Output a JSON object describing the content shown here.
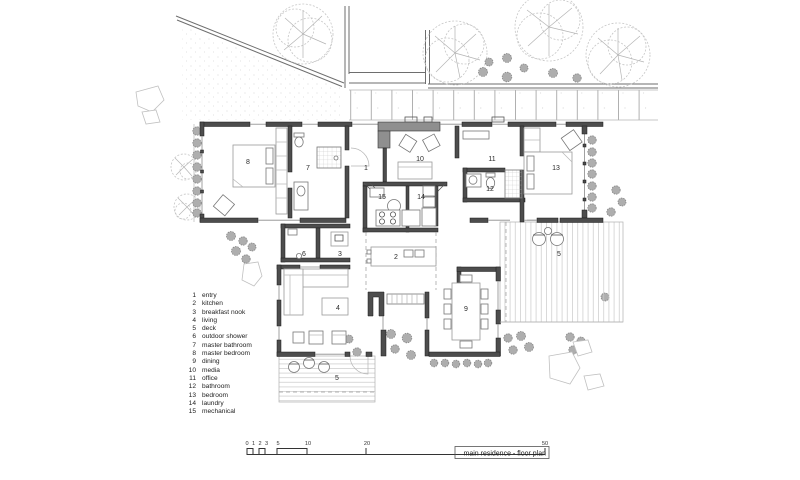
{
  "title_block": {
    "title": "main residence - floor plan"
  },
  "legend": {
    "items": [
      {
        "number": "1",
        "label": "entry"
      },
      {
        "number": "2",
        "label": "kitchen"
      },
      {
        "number": "3",
        "label": "breakfast nook"
      },
      {
        "number": "4",
        "label": "living"
      },
      {
        "number": "5",
        "label": "deck"
      },
      {
        "number": "6",
        "label": "outdoor shower"
      },
      {
        "number": "7",
        "label": "master bathroom"
      },
      {
        "number": "8",
        "label": "master bedroom"
      },
      {
        "number": "9",
        "label": "dining"
      },
      {
        "number": "10",
        "label": "media"
      },
      {
        "number": "11",
        "label": "office"
      },
      {
        "number": "12",
        "label": "bathroom"
      },
      {
        "number": "13",
        "label": "bedroom"
      },
      {
        "number": "14",
        "label": "laundry"
      },
      {
        "number": "15",
        "label": "mechanical"
      }
    ]
  },
  "plan": {
    "labels": {
      "r1": "1",
      "r2": "2",
      "r3": "3",
      "r4": "4",
      "r5_lower": "5",
      "r5_right": "5",
      "r6": "6",
      "r7": "7",
      "r8": "8",
      "r9": "9",
      "r10": "10",
      "r11": "11",
      "r12": "12",
      "r13": "13",
      "r14": "14",
      "r15": "15"
    }
  },
  "scale_bar": {
    "ticks": [
      "0",
      "1",
      "2",
      "3",
      "5",
      "10",
      "20",
      "50"
    ]
  },
  "colors": {
    "ink": "#1c1c1c",
    "wall_fill": "#4d4d4d",
    "wall_concrete": "#8f8f8f",
    "foliage": "#c6c6c6",
    "bush": "#aeaeae",
    "paper": "#ffffff"
  }
}
